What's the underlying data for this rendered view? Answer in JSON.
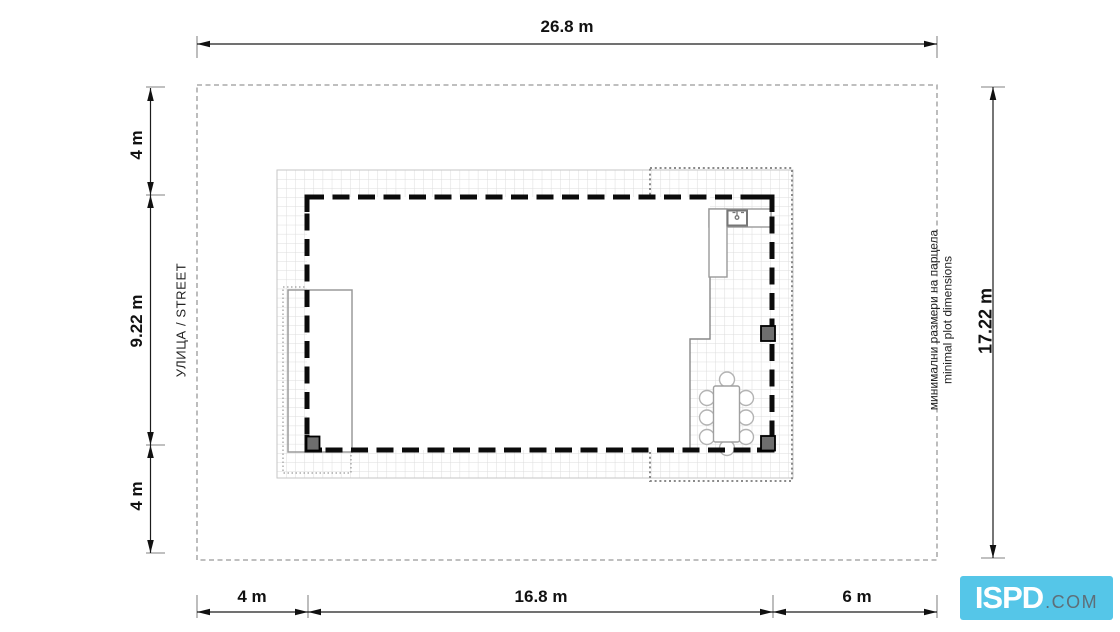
{
  "dims": {
    "top": "26.8 m",
    "bottom_left": "4 m",
    "bottom_mid": "16.8 m",
    "bottom_right": "6 m",
    "left_top": "4 m",
    "left_mid": "9.22 m",
    "left_bottom": "4 m",
    "right": "17.22 m"
  },
  "labels": {
    "street": "УЛИЦА / STREET",
    "note_bg": "минимални размери на парцела",
    "note_en": "minimal plot dimensions"
  },
  "logo": {
    "brand": "ISPD",
    "suffix": ".COM"
  },
  "colors": {
    "building_outline": "#0B0B0B",
    "plot_boundary": "#999999",
    "grid_line": "#DCDCDC",
    "column_fill": "#6E6E6E",
    "logo_bg": "#55C6E8",
    "logo_text": "#FFFFFF",
    "logo_suffix": "#5E6E78"
  }
}
